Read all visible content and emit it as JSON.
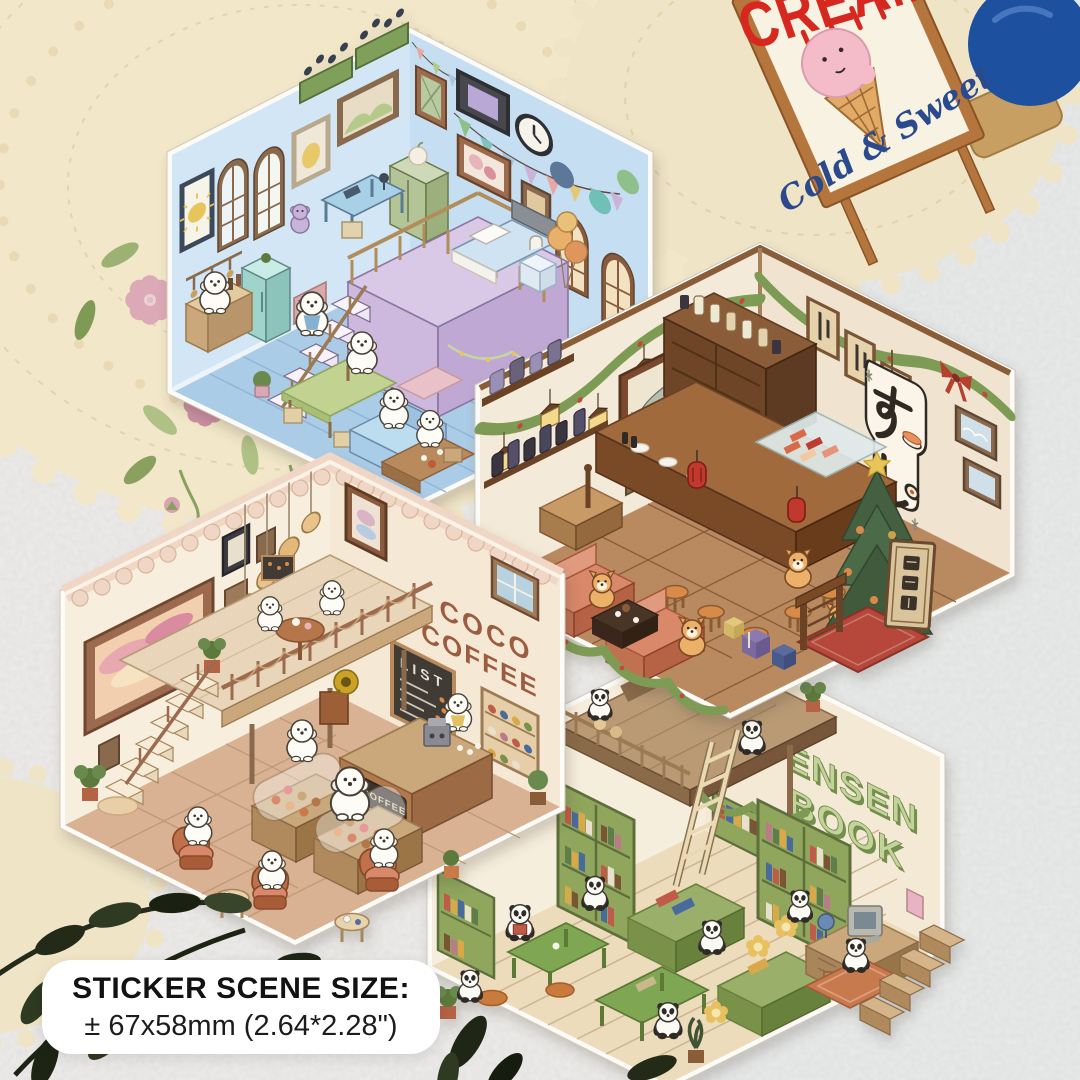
{
  "size_label": {
    "title": "STICKER SCENE SIZE:",
    "dimensions": "± 67x58mm (2.64*2.28\")"
  },
  "ice_cream_sign": {
    "top_text": "CREAM",
    "script_text": "Cold & Sweet"
  },
  "scenes": {
    "coffee_shop": {
      "wall_sign_line1": "COCO",
      "wall_sign_line2": "COFFEE",
      "menu_board_title": "LIST",
      "counter_sign_text": "COFFEE"
    },
    "book_store": {
      "wall_sign_line1": "ENSEN",
      "wall_sign_line2": "BOOK"
    },
    "sushi_bar": {
      "banner_text": "すし",
      "open_plaque_text": "営業中"
    }
  },
  "colors": {
    "background": "#edecea",
    "lace": "#f2e7c9",
    "sign_red": "#d6281e",
    "sign_blue": "#2b4a8e",
    "bedroom_wall": "#d3e6f5",
    "sushi_wood": "#8a5c38",
    "coffee_wall": "#f8eedd",
    "book_green": "#8fa65c"
  }
}
